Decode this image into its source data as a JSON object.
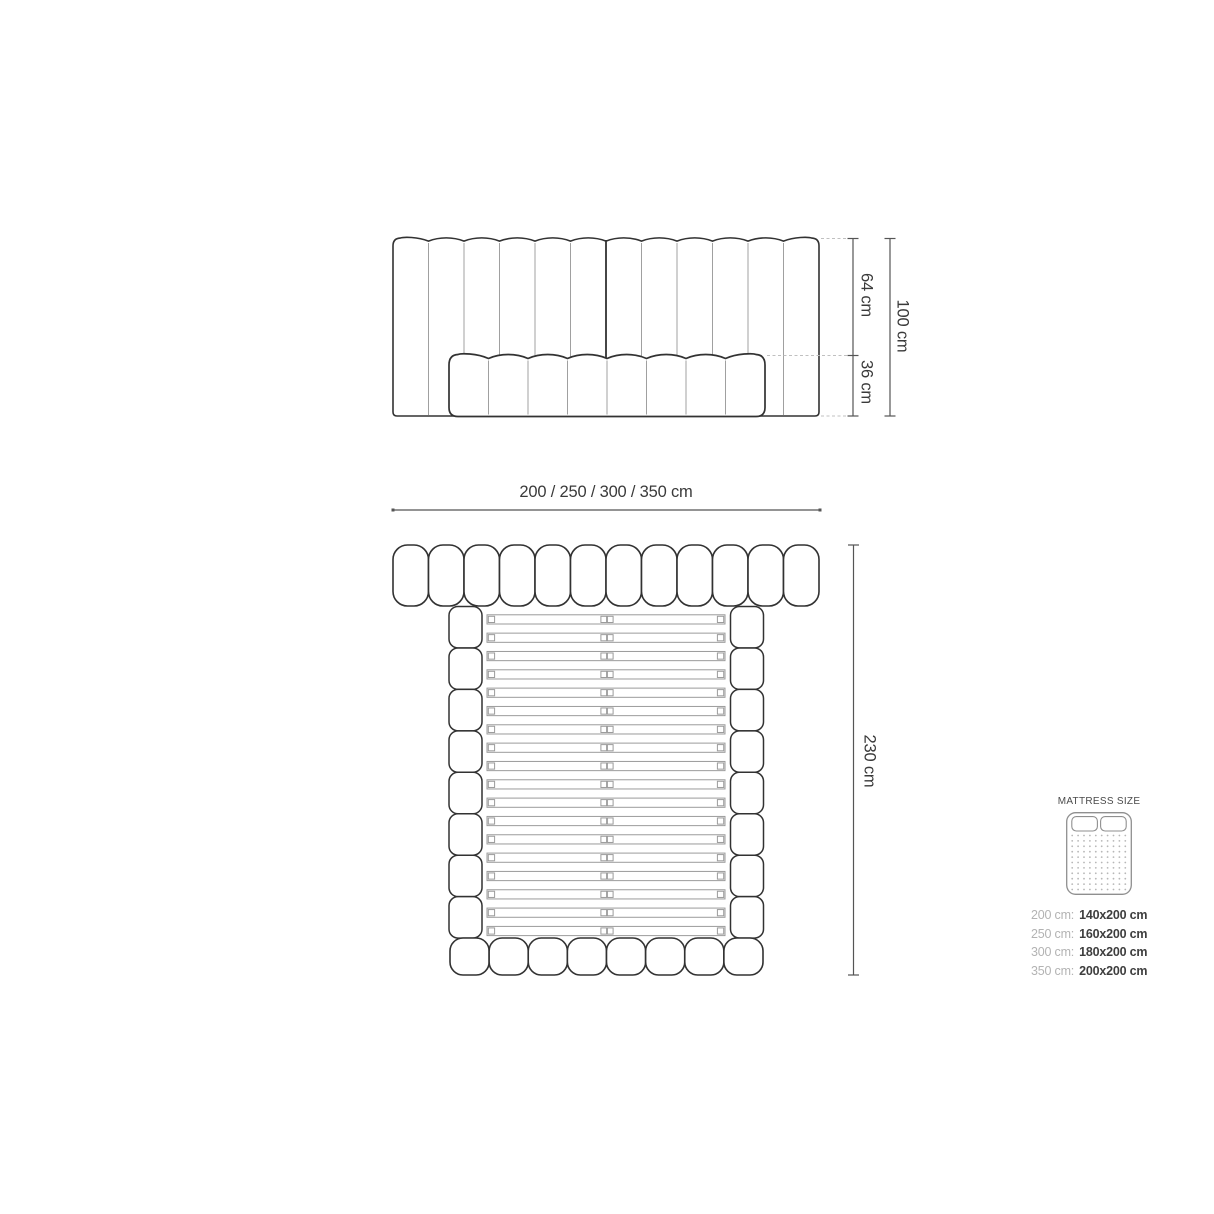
{
  "front_view": {
    "upper_height": "64 cm",
    "lower_height": "36 cm",
    "total_height": "100 cm"
  },
  "top_view": {
    "widths": "200 / 250 / 300 / 350 cm",
    "length": "230 cm"
  },
  "legend": {
    "title": "MATTRESS SIZE",
    "rows": [
      {
        "width": "200 cm:",
        "mattress": "140x200 cm"
      },
      {
        "width": "250 cm:",
        "mattress": "160x200 cm"
      },
      {
        "width": "300 cm:",
        "mattress": "180x200 cm"
      },
      {
        "width": "350 cm:",
        "mattress": "200x200 cm"
      }
    ]
  },
  "diagram": {
    "front_view": {
      "channels": 12,
      "mattress_segments": 8
    },
    "top_view": {
      "headboard_segments": 12,
      "slats": 18,
      "rail_segments": 8,
      "footboard_segments": 8
    },
    "icon": {
      "dot_columns": 10,
      "dot_rows": 11,
      "pillows": 2
    }
  },
  "colors": {
    "background": "#ffffff",
    "outline": "#323232",
    "thin_line": "#a0a0a0",
    "slat_line": "#9b9b9b",
    "dimension": "#555555",
    "dashed": "#c0c0c0",
    "label_text": "#3a3a3a",
    "legend_gray": "#b3b3b3",
    "legend_dark": "#3e3e3e",
    "icon_stroke": "#8f8f8f",
    "icon_dots": "#b7b7b7"
  }
}
